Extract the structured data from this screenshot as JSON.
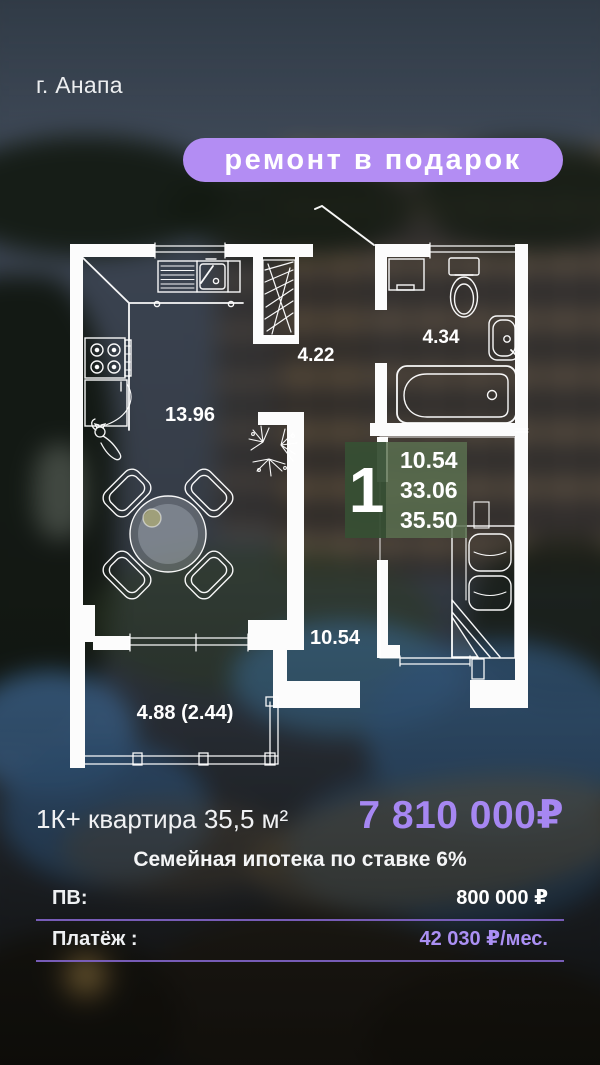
{
  "location": {
    "city": "г. Анапа"
  },
  "promo": {
    "badge": "ремонт в подарок"
  },
  "floorplan": {
    "room_areas": {
      "kitchen_living": "13.96",
      "hallway": "4.22",
      "bathroom": "4.34",
      "bedroom": "10.54",
      "balcony": "4.88 (2.44)"
    },
    "unit_card": {
      "rooms": "1",
      "living_area": "10.54",
      "area_without_balcony": "33.06",
      "total_area": "35.50"
    }
  },
  "offer": {
    "title": "1К+ квартира 35,5 м²",
    "price": "7 810 000₽",
    "mortgage": "Семейная ипотека по ставке 6%",
    "rows": [
      {
        "label": "ПВ:",
        "value": "800 000 ₽"
      },
      {
        "label": "Платёж :",
        "value": "42 030 ₽/мес."
      }
    ]
  },
  "colors": {
    "promo_pill": "#b38df3",
    "price_purple": "#a687f2",
    "payment_purple": "#ab90f4",
    "divider_purple": "#7c60c0",
    "badge_green_dark": "#374f34",
    "badge_green_light": "#5a7050",
    "plan_lines": "#ffffff"
  }
}
